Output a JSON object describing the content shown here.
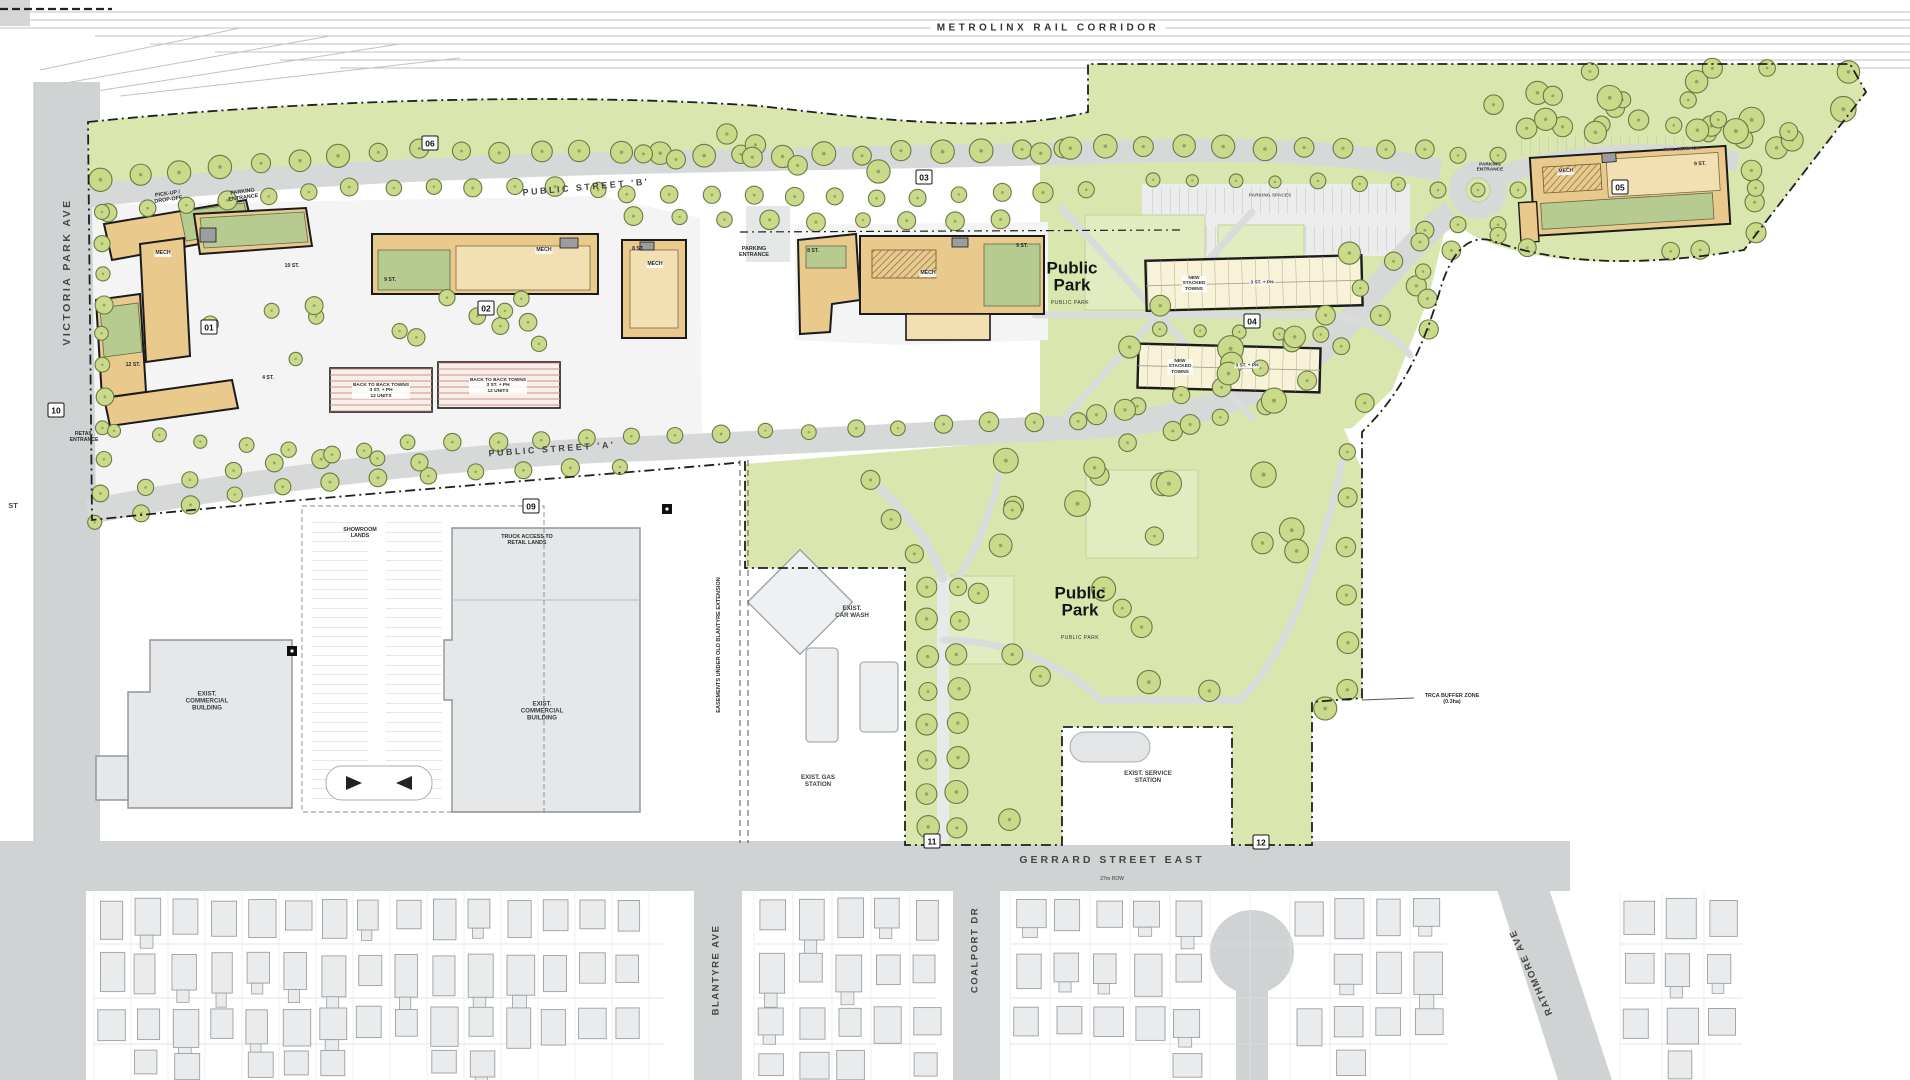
{
  "colors": {
    "site_green": "#d9e6ae",
    "building_tan": "#e9c98c",
    "building_tan_light": "#f2dfb2",
    "green_roof": "#b7cb90",
    "stacked_cream": "#f8f2d8",
    "road_gray": "#d3d5d6",
    "tree_green": "#c8d883",
    "tree_outline": "#6a7a45"
  },
  "rail": {
    "label": "METROLINX RAIL CORRIDOR"
  },
  "streets": {
    "victoria_park": "VICTORIA PARK AVE",
    "public_b": "PUBLIC STREET 'B'",
    "public_a": "PUBLIC STREET 'A'",
    "gerrard": "GERRARD STREET EAST",
    "blantyre": "BLANTYRE AVE",
    "coalport": "COALPORT DR",
    "rathmore": "RATHMORE AVE"
  },
  "parks": {
    "upper_title": "Public\nPark",
    "upper_sub": "PUBLIC PARK",
    "lower_title": "Public\nPark",
    "lower_sub": "PUBLIC PARK"
  },
  "badges": [
    {
      "id": "01",
      "x": 209,
      "y": 327
    },
    {
      "id": "02",
      "x": 486,
      "y": 308
    },
    {
      "id": "03",
      "x": 924,
      "y": 177
    },
    {
      "id": "04",
      "x": 1252,
      "y": 321
    },
    {
      "id": "05",
      "x": 1620,
      "y": 187
    },
    {
      "id": "06",
      "x": 430,
      "y": 143
    },
    {
      "id": "09",
      "x": 531,
      "y": 506
    },
    {
      "id": "10",
      "x": 56,
      "y": 410
    },
    {
      "id": "11",
      "x": 932,
      "y": 841
    },
    {
      "id": "12",
      "x": 1261,
      "y": 842
    }
  ],
  "annotations": [
    {
      "name": "pickup-dropoff-note",
      "t": "PICK-UP /\nDROP-OFF",
      "x": 168,
      "y": 197,
      "r": -8,
      "s": 5.4
    },
    {
      "name": "parking-entrance-note-b01",
      "t": "PARKING\nENTRANCE",
      "x": 243,
      "y": 195,
      "r": -8,
      "s": 5.4
    },
    {
      "name": "parking-entrance-note-b03",
      "t": "PARKING\nENTRANCE",
      "x": 754,
      "y": 252,
      "r": 0,
      "s": 5.4
    },
    {
      "name": "retail-entrance-note",
      "t": "RETAIL\nENTRANCE",
      "x": 84,
      "y": 438,
      "r": 0,
      "s": 5.2
    },
    {
      "name": "truck-access-note",
      "t": "TRUCK ACCESS TO\nRETAIL LANDS",
      "x": 527,
      "y": 540,
      "r": 0,
      "s": 5.4
    },
    {
      "name": "showroom-lands-note",
      "t": "SHOWROOM\nLANDS",
      "x": 360,
      "y": 533,
      "r": 0,
      "s": 5.4
    },
    {
      "name": "trca-buffer-note",
      "t": "TRCA BUFFER ZONE\n(0.3ha)",
      "x": 1452,
      "y": 699,
      "r": 0,
      "s": 5.4
    },
    {
      "name": "easement-note",
      "t": "EASEMENTS UNDER OLD BLANTYRE EXTENSION",
      "x": 719,
      "y": 645,
      "r": -90,
      "s": 5.6
    },
    {
      "name": "mech-label-b01",
      "t": "MECH",
      "x": 163,
      "y": 254,
      "r": 0,
      "s": 5.2,
      "bg": 1
    },
    {
      "name": "mech-label-b02-bar",
      "t": "MECH",
      "x": 544,
      "y": 251,
      "r": 0,
      "s": 5.2,
      "bg": 1
    },
    {
      "name": "mech-label-b02-tower",
      "t": "MECH",
      "x": 655,
      "y": 265,
      "r": 0,
      "s": 5.2,
      "bg": 1
    },
    {
      "name": "mech-label-b03",
      "t": "MECH",
      "x": 928,
      "y": 274,
      "r": 0,
      "s": 5.2,
      "bg": 1
    },
    {
      "name": "mech-label-b05",
      "t": "MECH",
      "x": 1566,
      "y": 172,
      "r": -3,
      "s": 5.2,
      "bg": 1
    },
    {
      "name": "storeys-b01-east",
      "t": "10 ST.",
      "x": 292,
      "y": 267,
      "r": 0,
      "s": 5.2
    },
    {
      "name": "storeys-b01-west",
      "t": "12 ST.",
      "x": 133,
      "y": 366,
      "r": 0,
      "s": 5.2
    },
    {
      "name": "storeys-b01-south",
      "t": "4 ST.",
      "x": 268,
      "y": 379,
      "r": 0,
      "s": 5.2
    },
    {
      "name": "storeys-b02-bar",
      "t": "9 ST.",
      "x": 390,
      "y": 281,
      "r": 0,
      "s": 5.2
    },
    {
      "name": "storeys-b02-tower",
      "t": "8 ST.",
      "x": 638,
      "y": 250,
      "r": 0,
      "s": 5.2
    },
    {
      "name": "storeys-b03-main",
      "t": "9 ST.",
      "x": 1022,
      "y": 247,
      "r": 0,
      "s": 5.2
    },
    {
      "name": "storeys-b03-west",
      "t": "8 ST.",
      "x": 813,
      "y": 252,
      "r": 0,
      "s": 5.2
    },
    {
      "name": "storeys-b05",
      "t": "9 ST.",
      "x": 1700,
      "y": 165,
      "r": -3,
      "s": 5.2
    },
    {
      "name": "back-to-back-label-1",
      "t": "BACK TO BACK TOWNS\n3 ST. + PH\n12 UNITS",
      "x": 381,
      "y": 391,
      "r": 0,
      "s": 4.8,
      "bg": 1
    },
    {
      "name": "back-to-back-label-2",
      "t": "BACK TO BACK TOWNS\n3 ST. + PH\n12 UNITS",
      "x": 498,
      "y": 386,
      "r": 0,
      "s": 4.8,
      "bg": 1
    },
    {
      "name": "stacked-towns-upper-name",
      "t": "NEW\nSTACKED\nTOWNS",
      "x": 1194,
      "y": 284,
      "r": 0,
      "s": 4.8,
      "bg": 1
    },
    {
      "name": "stacked-towns-upper-height",
      "t": "3 ST. + PH",
      "x": 1262,
      "y": 283,
      "r": 0,
      "s": 4.8,
      "bg": 1
    },
    {
      "name": "stacked-towns-lower-name",
      "t": "NEW\nSTACKED\nTOWNS",
      "x": 1180,
      "y": 367,
      "r": 0,
      "s": 4.8,
      "bg": 1
    },
    {
      "name": "stacked-towns-lower-height",
      "t": "3 ST. + PH",
      "x": 1247,
      "y": 366,
      "r": 0,
      "s": 4.8,
      "bg": 1
    },
    {
      "name": "parking-spaces-note",
      "t": "PARKING SPACES",
      "x": 1270,
      "y": 196,
      "r": 0,
      "s": 4.8,
      "c": "#666"
    },
    {
      "name": "parking-entrance-note-b05",
      "t": "PARKING\nENTRANCE",
      "x": 1490,
      "y": 168,
      "r": 0,
      "s": 4.8
    },
    {
      "name": "rail-setback-note",
      "t": "RAIL SETBACK",
      "x": 1682,
      "y": 150,
      "r": -3,
      "s": 4.8,
      "c": "#555"
    },
    {
      "name": "exist-commercial-1-label",
      "t": "EXIST.\nCOMMERCIAL\nBUILDING",
      "x": 207,
      "y": 702,
      "r": 0,
      "s": 6.2,
      "c": "#3a3f42"
    },
    {
      "name": "exist-commercial-2-label",
      "t": "EXIST.\nCOMMERCIAL\nBUILDING",
      "x": 542,
      "y": 712,
      "r": 0,
      "s": 6.2,
      "c": "#3a3f42"
    },
    {
      "name": "exist-car-wash-label",
      "t": "EXIST.\nCAR WASH",
      "x": 852,
      "y": 613,
      "r": 0,
      "s": 6.2,
      "c": "#3a3f42"
    },
    {
      "name": "exist-gas-station-label",
      "t": "EXIST. GAS\nSTATION",
      "x": 818,
      "y": 782,
      "r": 0,
      "s": 6.2,
      "c": "#3a3f42"
    },
    {
      "name": "exist-service-station-label",
      "t": "EXIST. SERVICE\nSTATION",
      "x": 1148,
      "y": 778,
      "r": 0,
      "s": 6.2,
      "c": "#3a3f42"
    },
    {
      "name": "gerrard-row-note",
      "t": "27m ROW",
      "x": 1112,
      "y": 880,
      "r": 0,
      "s": 5,
      "c": "#666"
    },
    {
      "name": "left-edge-street-label",
      "t": "ST",
      "x": 13,
      "y": 506,
      "r": 0,
      "s": 7.5,
      "c": "#454545"
    }
  ]
}
